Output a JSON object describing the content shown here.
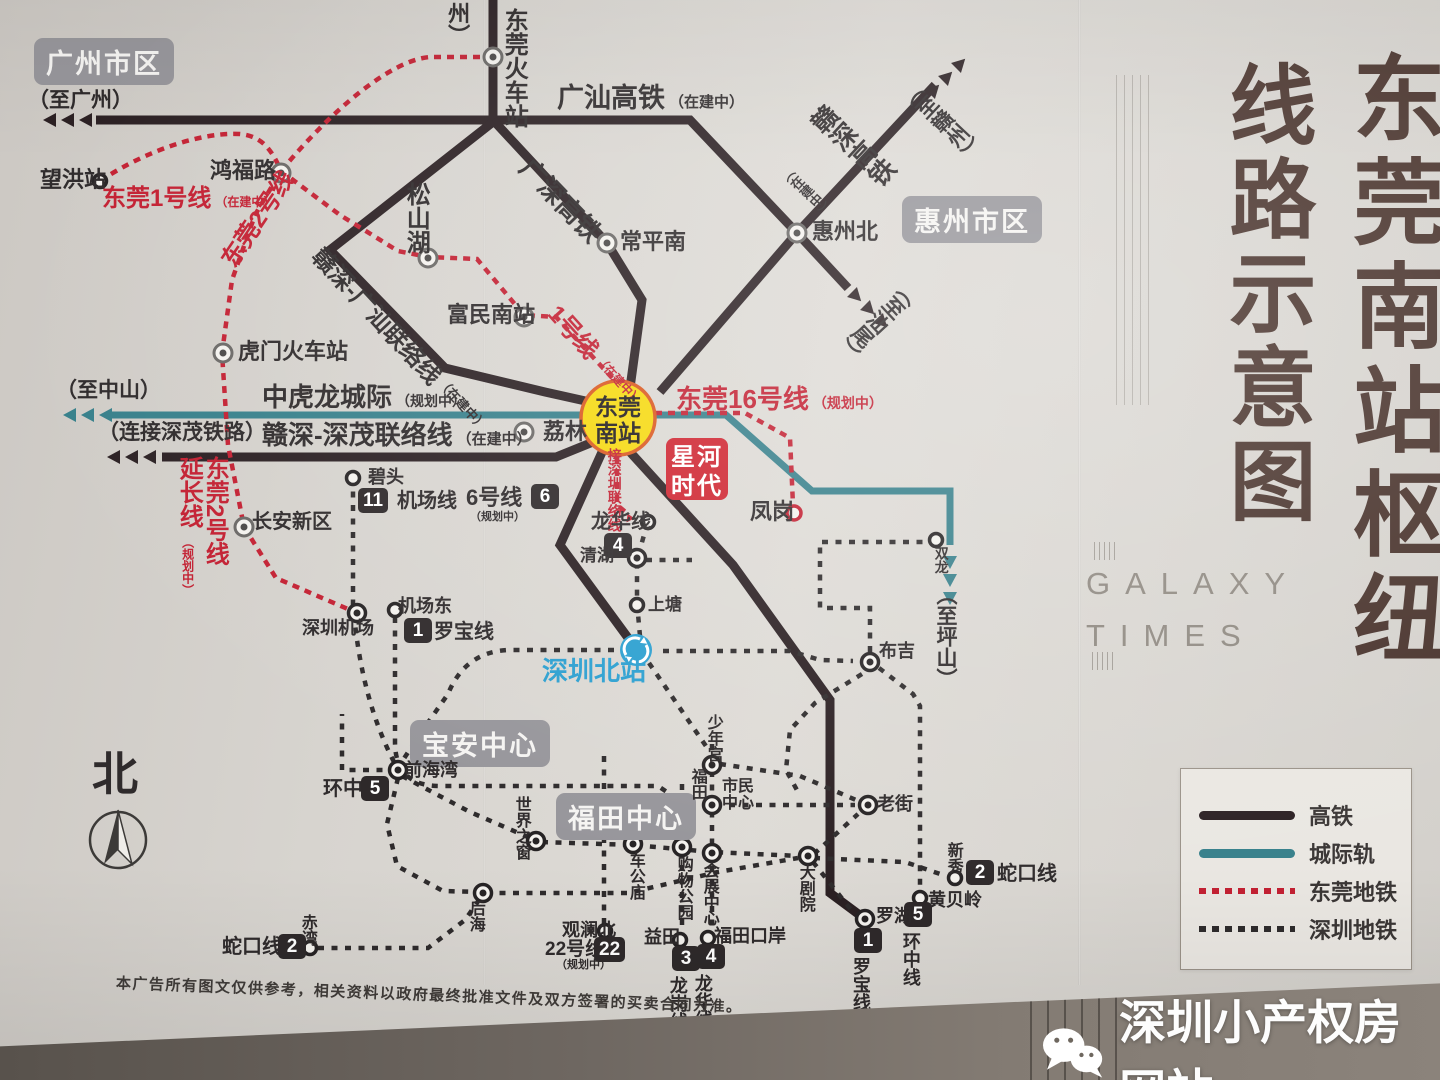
{
  "colors": {
    "hsr": "#2b2023",
    "intercity": "#37808b",
    "dg_metro": "#c32032",
    "sz_metro": "#2e2b2c",
    "station_yellow": "#f6d90f",
    "logo_red": "#cf2430",
    "title_brown": "#463029",
    "sz_blue": "#2a9fd0"
  },
  "common": {
    "under_construction": "（在建中）",
    "planning": "（规划中）"
  },
  "regions": {
    "guangzhou": "广州市区",
    "huizhou": "惠州市区",
    "baoan": "宝安中心",
    "futian": "福田中心"
  },
  "directions": {
    "to_guangzhou": "（至广州）",
    "to_zhongshan": "（至中山）",
    "to_ganzhou": "（至赣州）",
    "to_shanwei": "（至汕尾）",
    "to_pingshan": "（至坪山）",
    "zhou": "州）",
    "connect_shenmao": "（连接深茂铁路）"
  },
  "lines": {
    "guangshan": "广汕高铁",
    "guangshen": "广深高铁",
    "ganshen": "赣深高铁",
    "zhonghulong": "中虎龙城际",
    "ganshen_shenmao": "赣深-深茂联络线",
    "ganshen_guangshan": "赣深-广汕联络线",
    "dg1": "东莞1号线",
    "dg2": "东莞2号线",
    "dg16": "东莞16号线",
    "line1": "1号线",
    "yanchang": "延长线",
    "jiesz": "接深圳联络线",
    "jichang": "机场线",
    "line6": "6号线",
    "longhua": "龙华线",
    "luobao": "罗宝线",
    "huanzhong": "环中线",
    "shekou": "蛇口线",
    "longgang": "龙岗线",
    "line22": "22号线"
  },
  "badges": {
    "n11": "11",
    "n6": "6",
    "n4": "4",
    "n1": "1",
    "n5": "5",
    "n2": "2",
    "n22": "22",
    "n3": "3"
  },
  "stations": {
    "wanghong": "望洪站",
    "hongfulu": "鸿福路",
    "dgrailway": "东莞火车站",
    "changpingnan": "常平南",
    "huizhoubei": "惠州北",
    "songshanhu": "松山湖",
    "fuminnan": "富民南站",
    "humen": "虎门火车站",
    "lilin": "荔林",
    "dgnan1": "东莞",
    "dgnan2": "南站",
    "changan": "长安新区",
    "fenggang": "凤岗",
    "bitou": "碧头",
    "qinghu": "清湖",
    "shangtang": "上塘",
    "szbei": "深圳北站",
    "shuanglong": "双龙",
    "buji": "布吉",
    "jichangdong": "机场东",
    "szairport": "深圳机场",
    "qianhaiwan": "前海湾",
    "shijie": "世界之窗",
    "chegongmiao": "车公庙",
    "gouwu": "购物公园",
    "huizhan": "会展中心",
    "houhai": "后海",
    "shaoniangong": "少年宫",
    "shimin1": "市民",
    "shimin2": "中心",
    "futian": "福田",
    "laojie": "老街",
    "dajuyuan": "大剧院",
    "huangbeiling": "黄贝岭",
    "xinxiu": "新秀",
    "luohu": "罗湖",
    "guanlanbei": "观澜北",
    "yitian": "益田",
    "futiankouan": "福田口岸",
    "chiwan": "赤湾"
  },
  "logo": {
    "l1": "星河",
    "l2": "时代"
  },
  "panel": {
    "title_main": "东莞南站枢纽",
    "title_sub": "线路示意图",
    "latin1": "GALAXY",
    "latin2": "TIMES"
  },
  "legend": {
    "hsr": "高铁",
    "intercity": "城际轨",
    "dg_metro": "东莞地铁",
    "sz_metro": "深圳地铁"
  },
  "compass": {
    "north": "北"
  },
  "footer": {
    "disclaimer": "本广告所有图文仅供参考，相关资料以政府最终批准文件及双方签署的买卖合同为准。",
    "watermark": "深圳小产权房网站"
  }
}
